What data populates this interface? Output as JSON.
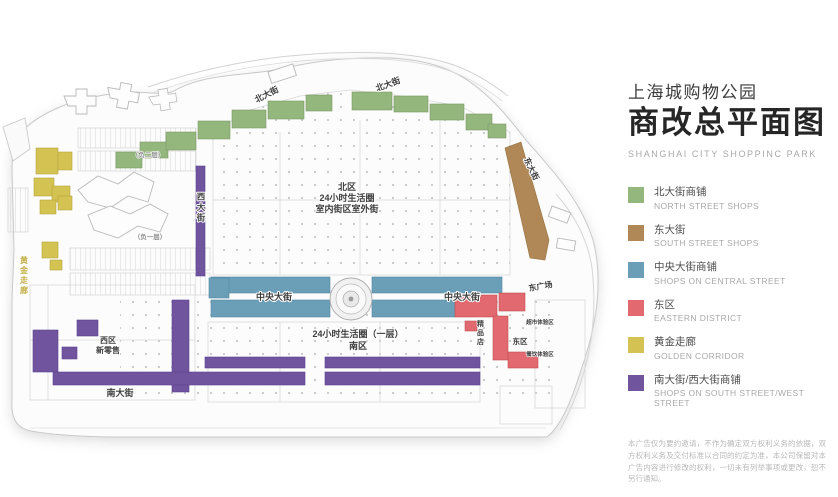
{
  "panel": {
    "title_zh_small": "上海城购物公园",
    "title_zh_big": "商改总平面图",
    "title_en": "SHANGHAI CITY SHOPPINC PARK",
    "legend": [
      {
        "color": "#93b77d",
        "zh": "北大街商铺",
        "en": "NORTH STREET SHOPS"
      },
      {
        "color": "#b08756",
        "zh": "东大街",
        "en": "SOUTH STREET SHOPS"
      },
      {
        "color": "#6b9fb8",
        "zh": "中央大街商铺",
        "en": "SHOPS ON CENTRAL STREET"
      },
      {
        "color": "#e2696f",
        "zh": "东区",
        "en": "EASTERN DISTRICT"
      },
      {
        "color": "#d4c253",
        "zh": "黄金走廊",
        "en": "GOLDEN CORRIDOR"
      },
      {
        "color": "#71549e",
        "zh": "南大街/西大街商铺",
        "en": "SHOPS ON SOUTH STREET/WEST STREET"
      }
    ],
    "disclaimer": "本广告仅为要约邀请，不作为确定双方权利义务的依据，双方权利义务及交付标准以合同的约定为准，本公司保留对本广告内容进行修改的权利，一切未有列举事项或更改，恕不另行通知。"
  },
  "map": {
    "labels": {
      "north_street_1": "北大街",
      "north_street_2": "北大街",
      "east_street": "东大街",
      "central_street_west": "中央大街",
      "central_street_east": "中央大街",
      "west_street": "西大街",
      "south_street": "南大街",
      "east_plaza": "东广场",
      "golden_corridor": "黄金走廊",
      "north_zone_line1": "北区",
      "north_zone_line2": "24小时生活圈",
      "north_zone_line3": "室内街区室外街",
      "south_zone_line1": "24小时生活圈（一层）",
      "south_zone_line2": "南区",
      "west_zone_line1": "西区",
      "west_zone_line2": "新零售",
      "east_zone": "东区",
      "boutique_vertical": "精品店",
      "exp_area_1": "超市体验区",
      "exp_area_2": "餐饮体验区",
      "parking_b2": "（负二层）",
      "parking_b1": "（负一层）"
    }
  }
}
